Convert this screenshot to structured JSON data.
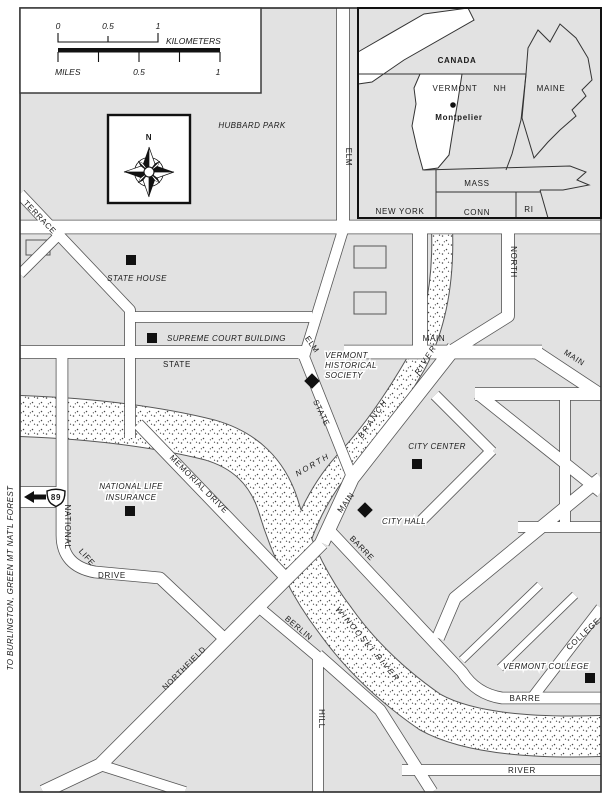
{
  "scale_bar": {
    "km_0": "0",
    "km_half": "0.5",
    "km_1": "1",
    "km_unit": "KILOMETERS",
    "mi_unit": "MILES",
    "mi_half": "0.5",
    "mi_1": "1"
  },
  "compass": {
    "north": "N"
  },
  "highway": {
    "route": "89"
  },
  "margin_note": {
    "to_burlington": "TO BURLINGTON, GREEN MT NAT'L FOREST"
  },
  "park": {
    "hubbard": "HUBBARD PARK"
  },
  "streets": {
    "elm_top": "ELM",
    "terrace": "TERRACE",
    "north_upper": "NORTH",
    "state_west": "STATE",
    "elm_diag": "ELM",
    "main_upper": "MAIN",
    "main_east": "MAIN",
    "state_diag": "STATE",
    "main_southwest": "MAIN",
    "memorial": "MEMORIAL DRIVE",
    "national": "NATIONAL",
    "life": "LIFE",
    "drive": "DRIVE",
    "barre_diag": "BARRE",
    "berlin": "BERLIN",
    "northfield": "NORTHFIELD",
    "hill": "HILL",
    "college": "COLLEGE",
    "barre_lower": "BARRE",
    "river_street": "RIVER"
  },
  "rivers": {
    "north": "NORTH",
    "branch": "BRANCH",
    "river": "RIVER",
    "winooski": "WINOOSKI RIVER"
  },
  "landmarks": {
    "state_house": "STATE HOUSE",
    "supreme_court": "SUPREME COURT BUILDING",
    "vhs1": "VERMONT",
    "vhs2": "HISTORICAL",
    "vhs3": "SOCIETY",
    "city_center": "CITY CENTER",
    "city_hall": "CITY HALL",
    "nli1": "NATIONAL LIFE",
    "nli2": "INSURANCE",
    "vermont_college": "VERMONT COLLEGE"
  },
  "inset": {
    "canada": "CANADA",
    "vermont": "VERMONT",
    "nh": "NH",
    "maine": "MAINE",
    "mass": "MASS",
    "conn": "CONN",
    "ri": "RI",
    "new_york": "NEW YORK",
    "city": "Montpelier"
  },
  "colors": {
    "land_gray": "#e2e2e2",
    "outline": "#565656",
    "ink": "#111111"
  }
}
